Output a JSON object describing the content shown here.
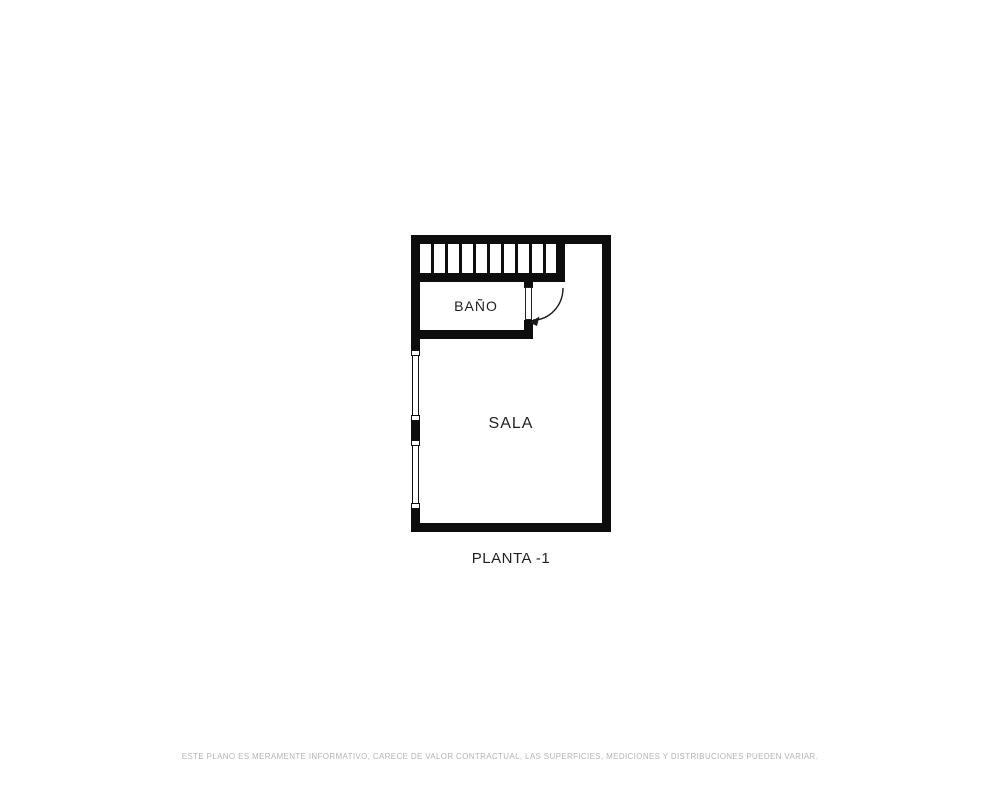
{
  "plan": {
    "rooms": [
      {
        "label": "BAÑO"
      },
      {
        "label": "SALA"
      }
    ],
    "caption": "PLANTA -1",
    "features": {
      "stairs_icon": "stairs",
      "door_icon": "door-swing-arc",
      "window_icon": "window"
    }
  },
  "footer": {
    "disclaimer": "ESTE PLANO ES MERAMENTE INFORMATIVO, CARECE DE VALOR CONTRACTUAL, LAS SUPERFICIES, MEDICIONES Y DISTRIBUCIONES PUEDEN VARIAR."
  },
  "colors": {
    "wall": "#0d0d0d",
    "background": "#ffffff",
    "label_text": "#1f1f1f",
    "disclaimer_text": "#b4b4b4"
  }
}
